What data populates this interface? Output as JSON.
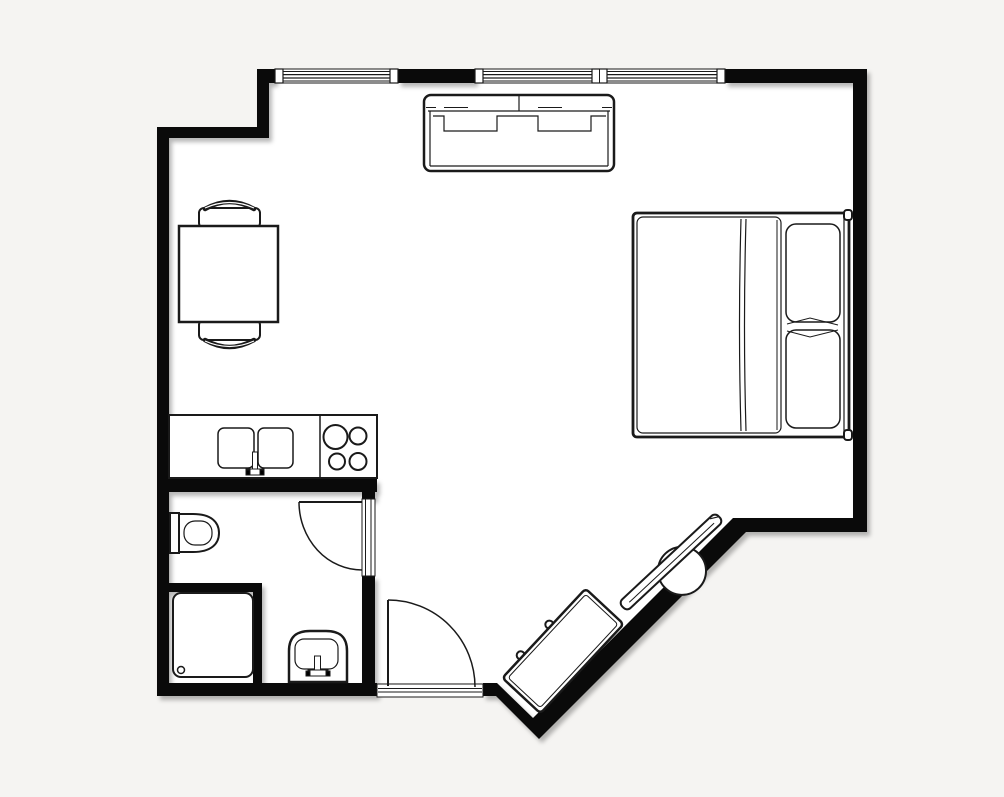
{
  "scene": {
    "kind": "floor-plan",
    "description": "black and white studio apartment floor plan, top-down line drawing",
    "rooms": [
      "main-room",
      "kitchenette",
      "bathroom",
      "entry-nook"
    ]
  },
  "colors": {
    "background": "#f5f4f2",
    "floor": "#ffffff",
    "wall": "#0a0a0a",
    "line": "#1a1a1a"
  },
  "openings": {
    "window_count": 2,
    "windows": [
      "window-left",
      "window-right-double"
    ],
    "doors": [
      "bathroom-door-with-swing-arc",
      "entry-door-with-swing-arc-and-threshold"
    ]
  },
  "furniture": [
    {
      "name": "sofa",
      "seats": 2
    },
    {
      "name": "double-bed",
      "pillows": 2
    },
    {
      "name": "dining-table"
    },
    {
      "name": "chair",
      "count": 2
    },
    {
      "name": "kitchen-counter",
      "features": [
        "double-sink",
        "faucet",
        "cooktop"
      ],
      "burners": 4
    },
    {
      "name": "toilet"
    },
    {
      "name": "shower-tray",
      "features": [
        "drain"
      ]
    },
    {
      "name": "washbasin",
      "features": [
        "tap"
      ]
    },
    {
      "name": "dresser",
      "knobs": 2
    },
    {
      "name": "tv-panel"
    }
  ]
}
